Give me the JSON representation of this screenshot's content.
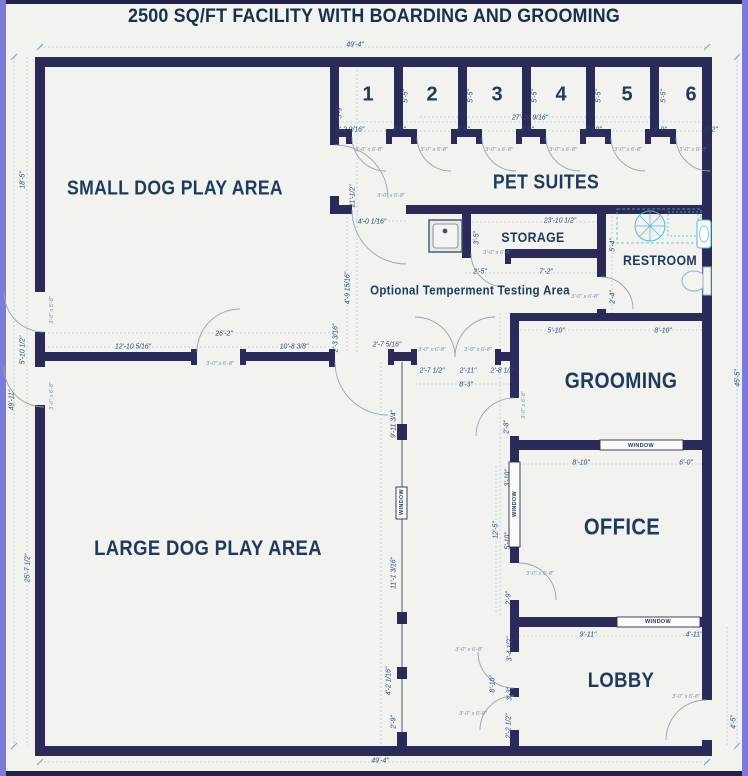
{
  "title": "2500 SQ/FT FACILITY WITH BOARDING AND GROOMING",
  "rooms": [
    {
      "id": "small-dog-play-area",
      "label": "SMALL DOG PLAY AREA",
      "x": 175,
      "y": 189,
      "fs": 20
    },
    {
      "id": "pet-suites",
      "label": "PET SUITES",
      "x": 546,
      "y": 183,
      "fs": 20
    },
    {
      "id": "storage",
      "label": "STORAGE",
      "x": 533,
      "y": 237,
      "fs": 14
    },
    {
      "id": "restroom",
      "label": "RESTROOM",
      "x": 660,
      "y": 260,
      "fs": 14
    },
    {
      "id": "testing-area",
      "label": "Optional Temperment Testing Area",
      "x": 470,
      "y": 290,
      "fs": 13
    },
    {
      "id": "grooming",
      "label": "GROOMING",
      "x": 621,
      "y": 381,
      "fs": 22
    },
    {
      "id": "office",
      "label": "OFFICE",
      "x": 622,
      "y": 527,
      "fs": 23
    },
    {
      "id": "lobby",
      "label": "LOBBY",
      "x": 621,
      "y": 681,
      "fs": 21
    },
    {
      "id": "large-dog-play-area",
      "label": "LARGE DOG PLAY AREA",
      "x": 208,
      "y": 549,
      "fs": 21
    }
  ],
  "suites": [
    {
      "label": "1",
      "x": 368,
      "y": 95
    },
    {
      "label": "2",
      "x": 432,
      "y": 95
    },
    {
      "label": "3",
      "x": 497,
      "y": 95
    },
    {
      "label": "4",
      "x": 561,
      "y": 95
    },
    {
      "label": "5",
      "x": 627,
      "y": 95
    },
    {
      "label": "6",
      "x": 691,
      "y": 95
    }
  ],
  "windows": {
    "text": "WINDOW",
    "positions": [
      {
        "x": 641,
        "y": 446
      },
      {
        "x": 658,
        "y": 622
      },
      {
        "x": 515,
        "y": 504,
        "v": 1
      },
      {
        "x": 402,
        "y": 502,
        "v": 1
      }
    ]
  },
  "door_tags": {
    "text": "3'-0\" x 6'-8\"",
    "positions": [
      {
        "x": 369,
        "y": 150
      },
      {
        "x": 434,
        "y": 150
      },
      {
        "x": 499,
        "y": 150
      },
      {
        "x": 563,
        "y": 150
      },
      {
        "x": 628,
        "y": 150
      },
      {
        "x": 693,
        "y": 150
      },
      {
        "x": 391,
        "y": 196
      },
      {
        "x": 220,
        "y": 364
      },
      {
        "x": 432,
        "y": 350
      },
      {
        "x": 478,
        "y": 350
      },
      {
        "x": 524,
        "y": 405,
        "v": 1
      },
      {
        "x": 540,
        "y": 574
      },
      {
        "x": 469,
        "y": 650
      },
      {
        "x": 473,
        "y": 714
      },
      {
        "x": 686,
        "y": 697
      },
      {
        "x": 497,
        "y": 253
      },
      {
        "x": 585,
        "y": 297
      },
      {
        "x": 52,
        "y": 310,
        "v": 1
      },
      {
        "x": 52,
        "y": 396,
        "v": 1
      }
    ]
  },
  "dimensions": [
    {
      "t": "49'-4\"",
      "x": 355,
      "y": 44
    },
    {
      "t": "49'-4\"",
      "x": 380,
      "y": 760
    },
    {
      "t": "18'-5\"",
      "x": 22,
      "y": 180,
      "v": 1
    },
    {
      "t": "5'-10 1/2\"",
      "x": 22,
      "y": 350,
      "v": 1
    },
    {
      "t": "49'-11\"",
      "x": 11,
      "y": 400,
      "v": 1
    },
    {
      "t": "25'-7 1/2\"",
      "x": 27,
      "y": 568,
      "v": 1
    },
    {
      "t": "45'-5\"",
      "x": 737,
      "y": 378,
      "v": 1
    },
    {
      "t": "4'-5\"",
      "x": 733,
      "y": 722,
      "v": 1
    },
    {
      "t": "27'-10 9/16\"",
      "x": 530,
      "y": 117
    },
    {
      "t": "2'-2 9/16\"",
      "x": 350,
      "y": 129
    },
    {
      "t": "4'-9\"",
      "x": 399,
      "y": 129
    },
    {
      "t": "4'-5\"",
      "x": 463,
      "y": 129
    },
    {
      "t": "4'-9\"",
      "x": 527,
      "y": 129
    },
    {
      "t": "4'-10\"",
      "x": 593,
      "y": 129
    },
    {
      "t": "4'-9\"",
      "x": 660,
      "y": 129
    },
    {
      "t": "2'-2\"",
      "x": 711,
      "y": 129
    },
    {
      "t": "5'-5\"",
      "x": 405,
      "y": 96,
      "v": 1
    },
    {
      "t": "5'-5\"",
      "x": 470,
      "y": 96,
      "v": 1
    },
    {
      "t": "5'-5\"",
      "x": 534,
      "y": 96,
      "v": 1
    },
    {
      "t": "5'-5\"",
      "x": 598,
      "y": 96,
      "v": 1
    },
    {
      "t": "5'-5\"",
      "x": 663,
      "y": 96,
      "v": 1
    },
    {
      "t": "5'-9\"",
      "x": 339,
      "y": 112,
      "v": 1
    },
    {
      "t": "21'-1/2\"",
      "x": 352,
      "y": 196,
      "v": 1
    },
    {
      "t": "4'-0 1/16\"",
      "x": 372,
      "y": 221
    },
    {
      "t": "23'-10 1/2\"",
      "x": 560,
      "y": 220
    },
    {
      "t": "3'-5\"",
      "x": 476,
      "y": 238,
      "v": 1
    },
    {
      "t": "2'-5\"",
      "x": 480,
      "y": 271
    },
    {
      "t": "7'-2\"",
      "x": 546,
      "y": 271
    },
    {
      "t": "5'-4\"",
      "x": 612,
      "y": 245,
      "v": 1
    },
    {
      "t": "2'-4\"",
      "x": 612,
      "y": 297,
      "v": 1
    },
    {
      "t": "26'-2\"",
      "x": 224,
      "y": 333
    },
    {
      "t": "12'-10 5/16\"",
      "x": 133,
      "y": 346
    },
    {
      "t": "10'-8 3/8\"",
      "x": 294,
      "y": 346
    },
    {
      "t": "2'-3 3/16\"",
      "x": 335,
      "y": 338,
      "v": 1
    },
    {
      "t": "4'-9 15/16\"",
      "x": 347,
      "y": 288,
      "v": 1
    },
    {
      "t": "2'-7 5/16\"",
      "x": 387,
      "y": 344
    },
    {
      "t": "2'-7 1/2\"",
      "x": 432,
      "y": 370
    },
    {
      "t": "2'-11\"",
      "x": 468,
      "y": 370
    },
    {
      "t": "2'-8 1/2\"",
      "x": 503,
      "y": 370
    },
    {
      "t": "8'-3\"",
      "x": 466,
      "y": 384
    },
    {
      "t": "5'-10\"",
      "x": 556,
      "y": 330
    },
    {
      "t": "8'-10\"",
      "x": 663,
      "y": 330
    },
    {
      "t": "8'-10\"",
      "x": 581,
      "y": 462
    },
    {
      "t": "6'-0\"",
      "x": 686,
      "y": 462
    },
    {
      "t": "2'-8\"",
      "x": 506,
      "y": 427,
      "v": 1
    },
    {
      "t": "3'-10\"",
      "x": 507,
      "y": 478,
      "v": 1
    },
    {
      "t": "12'-5\"",
      "x": 495,
      "y": 530,
      "v": 1
    },
    {
      "t": "5'-10\"",
      "x": 507,
      "y": 541,
      "v": 1
    },
    {
      "t": "2'-9\"",
      "x": 508,
      "y": 598,
      "v": 1
    },
    {
      "t": "9'-11\"",
      "x": 588,
      "y": 634
    },
    {
      "t": "4'-11\"",
      "x": 694,
      "y": 634
    },
    {
      "t": "9'-11 3/4\"",
      "x": 393,
      "y": 424,
      "v": 1
    },
    {
      "t": "11'-1 3/16\"",
      "x": 393,
      "y": 573,
      "v": 1
    },
    {
      "t": "4'-2 1/16\"",
      "x": 388,
      "y": 681,
      "v": 1
    },
    {
      "t": "2'-9\"",
      "x": 393,
      "y": 722,
      "v": 1
    },
    {
      "t": "3'-4 1/2\"",
      "x": 509,
      "y": 649,
      "v": 1
    },
    {
      "t": "8'-10\"",
      "x": 492,
      "y": 684,
      "v": 1
    },
    {
      "t": "3'-3\"",
      "x": 509,
      "y": 694,
      "v": 1
    },
    {
      "t": "2'-2 1/2\"",
      "x": 508,
      "y": 726,
      "v": 1
    }
  ],
  "colors": {
    "wall": "#2b2a58",
    "canvas": "#f2f2ee",
    "frame": "#7c7ada",
    "frame_dark": "#23224e",
    "dim_line": "#b5cfdf",
    "dim_text": "#1f4878",
    "label": "#1d3a5f",
    "fixture_cyan": "#49b8d8"
  }
}
